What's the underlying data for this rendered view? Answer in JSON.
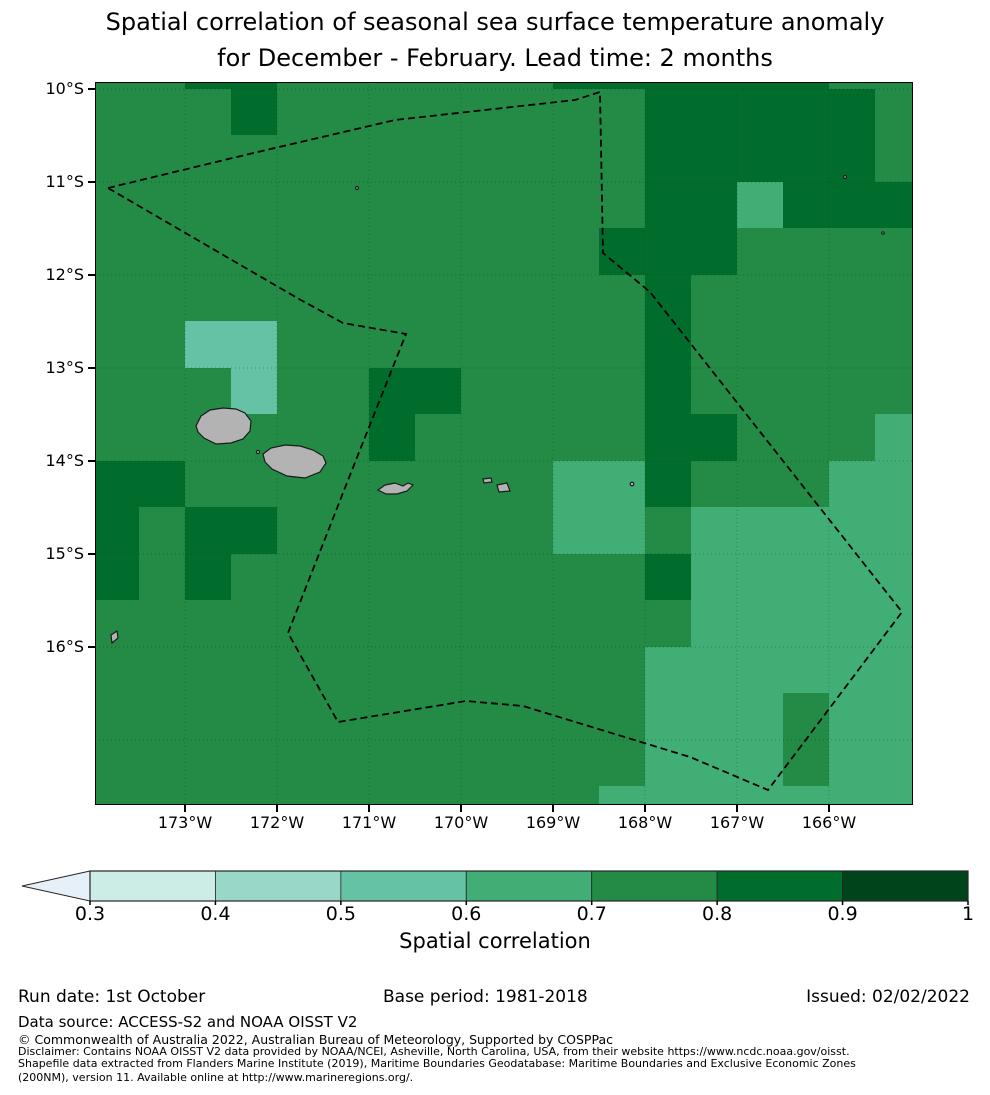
{
  "title": {
    "line1": "Spatial correlation of seasonal sea surface temperature anomaly",
    "line2": "for December - February. Lead time: 2 months"
  },
  "map": {
    "lat_tick_labels": [
      "10°S",
      "11°S",
      "12°S",
      "13°S",
      "14°S",
      "15°S",
      "16°S"
    ],
    "lon_tick_labels": [
      "173°W",
      "172°W",
      "171°W",
      "170°W",
      "169°W",
      "168°W",
      "167°W",
      "166°W"
    ]
  },
  "colorbar": {
    "tick_labels": [
      "0.3",
      "0.4",
      "0.5",
      "0.6",
      "0.7",
      "0.8",
      "0.9",
      "1"
    ],
    "label": "Spatial correlation",
    "segment_colors": [
      "#ccece6",
      "#99d8c9",
      "#66c2a4",
      "#41ae76",
      "#238b45",
      "#006d2c",
      "#00441b"
    ],
    "under_arrow_color": "#e5f0f9",
    "outline_color": "#262626"
  },
  "footer": {
    "run_date": "Run date: 1st October",
    "base_period": "Base period: 1981-2018",
    "issued": "Issued: 02/02/2022",
    "data_source": "Data source: ACCESS-S2 and NOAA OISST V2",
    "copyright": "© Commonwealth of Australia 2022, Australian Bureau of Meteorology, Supported by COSPPac",
    "disclaimer_lines": [
      "Disclaimer: Contains NOAA OISST V2 data provided by NOAA/NCEI, Asheville, North Carolina, USA, from their website https://www.ncdc.noaa.gov/oisst.",
      "Shapefile data extracted from Flanders Marine Institute (2019), Maritime Boundaries Geodatabase: Maritime Boundaries and Exclusive Economic Zones",
      "(200NM), version 11. Available online at http://www.marineregions.org/."
    ]
  },
  "chart_data": {
    "type": "heatmap",
    "title": "Spatial correlation of seasonal sea surface temperature anomaly for December - February. Lead time: 2 months",
    "colorbar_label": "Spatial correlation",
    "colorbar_ticks": [
      0.3,
      0.4,
      0.5,
      0.6,
      0.7,
      0.8,
      0.9,
      1.0
    ],
    "colorbar_extend": "min",
    "x_tick_labels": [
      "173°W",
      "172°W",
      "171°W",
      "170°W",
      "169°W",
      "168°W",
      "167°W",
      "166°W"
    ],
    "y_tick_labels": [
      "10°S",
      "11°S",
      "12°S",
      "13°S",
      "14°S",
      "15°S",
      "16°S"
    ],
    "lon_range_deg_w": [
      174.0,
      165.1
    ],
    "lat_range_deg_s": [
      9.9,
      17.7
    ],
    "grid_cell_deg": 0.5,
    "value_key": "digit d means spatial correlation in [d/10, (d+1)/10]",
    "level_colors": {
      "5": "#66c2a4",
      "6": "#41ae76",
      "7": "#238b45",
      "8": "#006d2c"
    },
    "correlation_grid_rows": [
      "778877777788888877",
      "777877777777888887",
      "777777777777888887",
      "777777777777886888",
      "777777777778887777",
      "777777777777877777",
      "775577777777877777",
      "777577887777877777",
      "777777877777887776",
      "887777777766877766",
      "878877777766766666",
      "878777777777866666",
      "777777777777766666",
      "777777777777666666",
      "777777777777666766",
      "777777777777666766",
      "777777777776666666"
    ],
    "eez_boundary_px": "13,106 150,73 300,38 480,18 505,10 508,171 555,210 807,530 673,708 595,675 428,624 371,619 243,640 193,551 257,388 311,252 248,241 204,217",
    "islands_px": {
      "savaii": "M101,344 L106,334 L115,328 L128,326 L141,327 L150,331 L156,339 L155,349 L148,357 L136,361 L121,362 L109,356 L103,350 Z",
      "upolu": "M168,372 L176,366 L190,363 L205,364 L218,368 L228,374 L231,381 L225,390 L210,396 L192,394 L177,387 L170,380 Z",
      "tutuila": "M283,408 L290,403 L300,401 L308,404 L313,401 L318,403 L312,409 L302,412 L291,412 Z",
      "ofu_olosega": "M388,397 L396,396 L397,400 L389,401 Z",
      "tau": "M402,403 L412,401 L415,409 L404,410 Z",
      "small_island_sw": "M16,553 L22,549 L23,556 L17,561 Z"
    },
    "island_dots_px": [
      {
        "x": 163,
        "y": 370,
        "r": 1.6
      },
      {
        "x": 537,
        "y": 402,
        "r": 1.8
      },
      {
        "x": 262,
        "y": 106,
        "r": 1.5
      },
      {
        "x": 750,
        "y": 95,
        "r": 1.5
      },
      {
        "x": 788,
        "y": 151,
        "r": 1.2
      }
    ],
    "island_fill": "#b3b3b3",
    "island_stroke": "#1a1a1a",
    "eez_line_color": "#000000",
    "graticule_color": "rgba(0,50,20,0.35)"
  }
}
